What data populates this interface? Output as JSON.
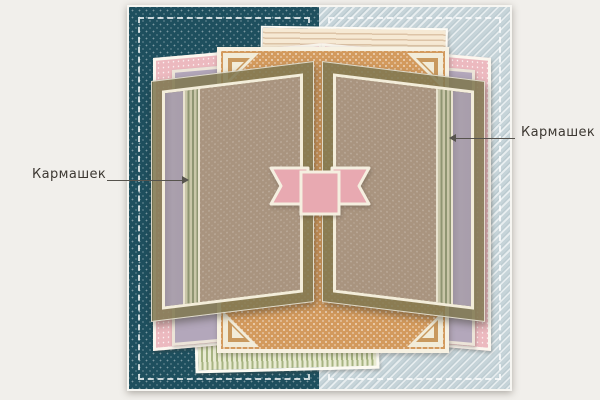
{
  "diagram": {
    "type": "scrapbook-layout-sketch",
    "labels": {
      "left_pocket": "Кармашек",
      "right_pocket": "Кармашек"
    },
    "palette": {
      "page_bg": "#f1efeb",
      "teal_dotted_base": "#1e4f5e",
      "blue_diagonal_base": "#c6d4d9",
      "pink_dotted_paper": "#ecb9bf",
      "cream_striped_paper": "#f6e9d4",
      "green_striped_paper": "#a7b482",
      "orange_dotted_paper": "#d39a5d",
      "olive_panel": "#7f7750",
      "brown_dotted_paper": "#a9947f",
      "lavender_pocket": "#a89dab",
      "ribbon_pink": "#e8a9b1",
      "frame_cream": "#f3edda"
    }
  }
}
